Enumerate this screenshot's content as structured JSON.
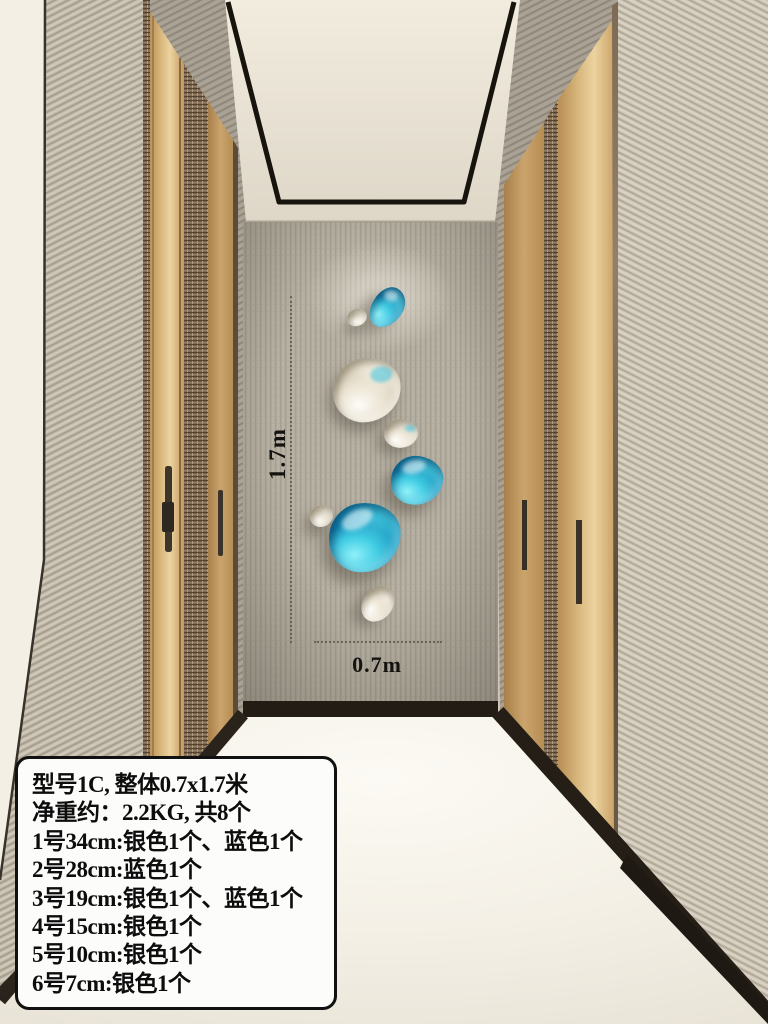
{
  "colors": {
    "decor_blue": "#1a9ac4",
    "decor_blue_light": "#3cbdd6",
    "decor_blue_dark": "#085580",
    "decor_silver": "#d8cfba",
    "decor_silver_light": "#f4eee1",
    "decor_silver_dark": "#968b72",
    "annotation_text": "#15130f",
    "spec_box_bg": "#fcfcfa",
    "spec_box_border": "#111111"
  },
  "annotations": {
    "height_label": "1.7m",
    "width_label": "0.7m"
  },
  "spec_box": {
    "lines": [
      "型号1C, 整体0.7x1.7米",
      "净重约：2.2KG, 共8个",
      "1号34cm:银色1个、蓝色1个",
      "2号28cm:蓝色1个",
      "3号19cm:银色1个、蓝色1个",
      "4号15cm:银色1个",
      "5号10cm:银色1个",
      "6号7cm:银色1个"
    ]
  },
  "wall_decor": {
    "piece_count": 8,
    "pieces": [
      {
        "id": 1,
        "color": "blue"
      },
      {
        "id": 2,
        "color": "silver"
      },
      {
        "id": 3,
        "color": "silver"
      },
      {
        "id": 4,
        "color": "silver"
      },
      {
        "id": 5,
        "color": "blue"
      },
      {
        "id": 6,
        "color": "silver"
      },
      {
        "id": 7,
        "color": "blue"
      },
      {
        "id": 8,
        "color": "silver"
      }
    ]
  }
}
